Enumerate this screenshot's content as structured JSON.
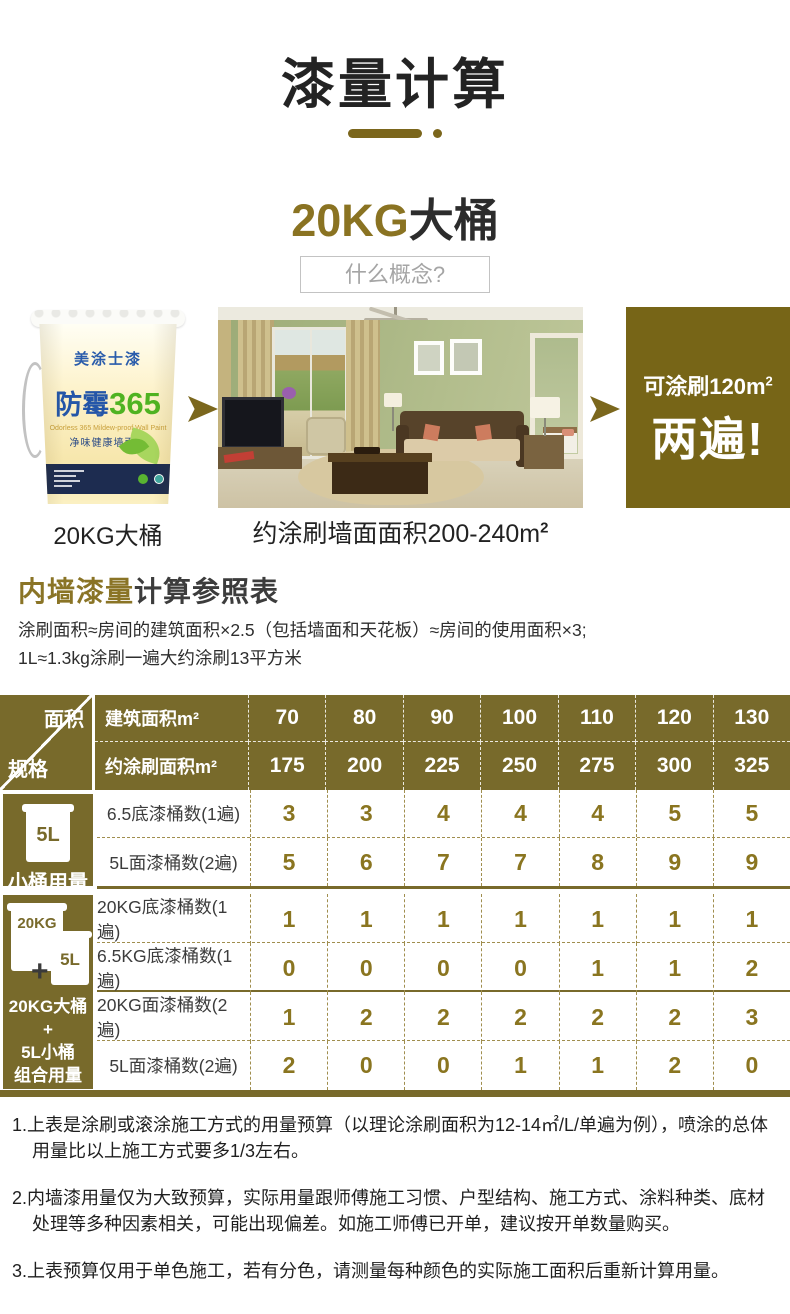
{
  "colors": {
    "olive": "#786a2b",
    "gold": "#8a7322",
    "dark_text": "#2c2c2c",
    "value_text": "#8a7520"
  },
  "header": {
    "title": "漆量计算",
    "subtitle_highlight": "20KG",
    "subtitle_rest": "大桶",
    "question_button_label": "什么概念?"
  },
  "hero": {
    "bucket": {
      "brand": "美涂士漆",
      "series_cn": "防霉",
      "series_num": "365",
      "sub_en": "Odorless 365 Mildew-proof Wall Paint",
      "sub_cn": "净味健康墙面漆"
    },
    "bucket_caption": "20KG大桶",
    "room_caption_text": "约涂刷墙面面积200-240m",
    "room_caption_sup": "2",
    "result_line1": "可涂刷120m",
    "result_line1_sup": "2",
    "result_line2": "两遍!"
  },
  "section": {
    "heading_highlight": "内墙漆量",
    "heading_rest": "计算参照表",
    "desc_line1": "涂刷面积≈房间的建筑面积×2.5（包括墙面和天花板）≈房间的使用面积×3;",
    "desc_line2": "1L≈1.3kg涂刷一遍大约涂刷13平方米"
  },
  "table": {
    "corner_top": "面积",
    "corner_bottom": "规格",
    "header_rows": [
      {
        "label": "建筑面积m²",
        "values": [
          "70",
          "80",
          "90",
          "100",
          "110",
          "120",
          "130"
        ]
      },
      {
        "label": "约涂刷面积m²",
        "values": [
          "175",
          "200",
          "225",
          "250",
          "275",
          "300",
          "325"
        ]
      }
    ],
    "group1": {
      "bucket_label": "5L",
      "caption": "小桶用量",
      "rows": [
        {
          "label": "6.5底漆桶数(1遍)",
          "values": [
            "3",
            "3",
            "4",
            "4",
            "4",
            "5",
            "5"
          ]
        },
        {
          "label": "5L面漆桶数(2遍)",
          "values": [
            "5",
            "6",
            "7",
            "7",
            "8",
            "9",
            "9"
          ]
        }
      ]
    },
    "group2": {
      "bucket_label_big": "20KG",
      "plus": "+",
      "bucket_label_small": "5L",
      "caption_line1": "20KG大桶",
      "caption_line2": "+",
      "caption_line3": "5L小桶",
      "caption_line4": "组合用量",
      "rows": [
        {
          "label": "20KG底漆桶数(1遍)",
          "values": [
            "1",
            "1",
            "1",
            "1",
            "1",
            "1",
            "1"
          ]
        },
        {
          "label": "6.5KG底漆桶数(1遍)",
          "values": [
            "0",
            "0",
            "0",
            "0",
            "1",
            "1",
            "2"
          ]
        },
        {
          "label": "20KG面漆桶数(2遍)",
          "values": [
            "1",
            "2",
            "2",
            "2",
            "2",
            "2",
            "3"
          ]
        },
        {
          "label": "5L面漆桶数(2遍)",
          "values": [
            "2",
            "0",
            "0",
            "1",
            "1",
            "2",
            "0"
          ]
        }
      ]
    }
  },
  "notes": [
    "1.上表是涂刷或滚涂施工方式的用量预算（以理论涂刷面积为12-14㎡/L/单遍为例），喷涂的总体用量比以上施工方式要多1/3左右。",
    "2.内墙漆用量仅为大致预算，实际用量跟师傅施工习惯、户型结构、施工方式、涂料种类、底材处理等多种因素相关，可能出现偏差。如施工师傅已开单，建议按开单数量购买。",
    "3.上表预算仅用于单色施工，若有分色，请测量每种颜色的实际施工面积后重新计算用量。"
  ]
}
